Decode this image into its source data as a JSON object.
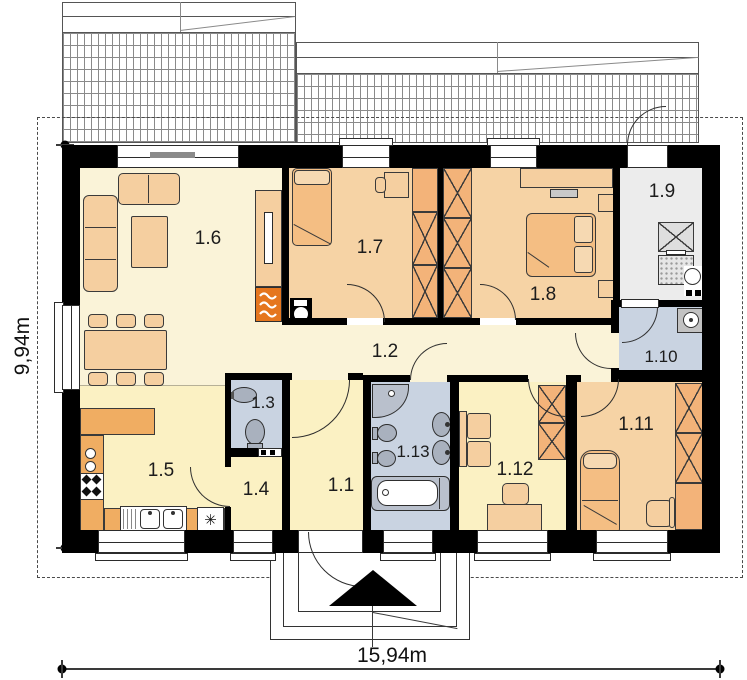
{
  "plan_type": "floor-plan",
  "rooms": {
    "r1_1": "1.1",
    "r1_2": "1.2",
    "r1_3": "1.3",
    "r1_4": "1.4",
    "r1_5": "1.5",
    "r1_6": "1.6",
    "r1_7": "1.7",
    "r1_8": "1.8",
    "r1_9": "1.9",
    "r1_10": "1.10",
    "r1_11": "1.11",
    "r1_12": "1.12",
    "r1_13": "1.13"
  },
  "dimensions": {
    "width_label": "15,94m",
    "height_label": "9,94m"
  },
  "symbols": {
    "dishwasher": "✳"
  },
  "colors": {
    "wall": "#000000",
    "living_floor": "#FAF3D8",
    "bedroom_floor": "#F6D3A5",
    "service_floor": "#FBF1C3",
    "bath_floor": "#C9D3E1",
    "utility_floor": "#ECECEC",
    "counter": "#F0AD62",
    "wardrobe": "#F3B379",
    "fireplace": "#E5761E"
  }
}
